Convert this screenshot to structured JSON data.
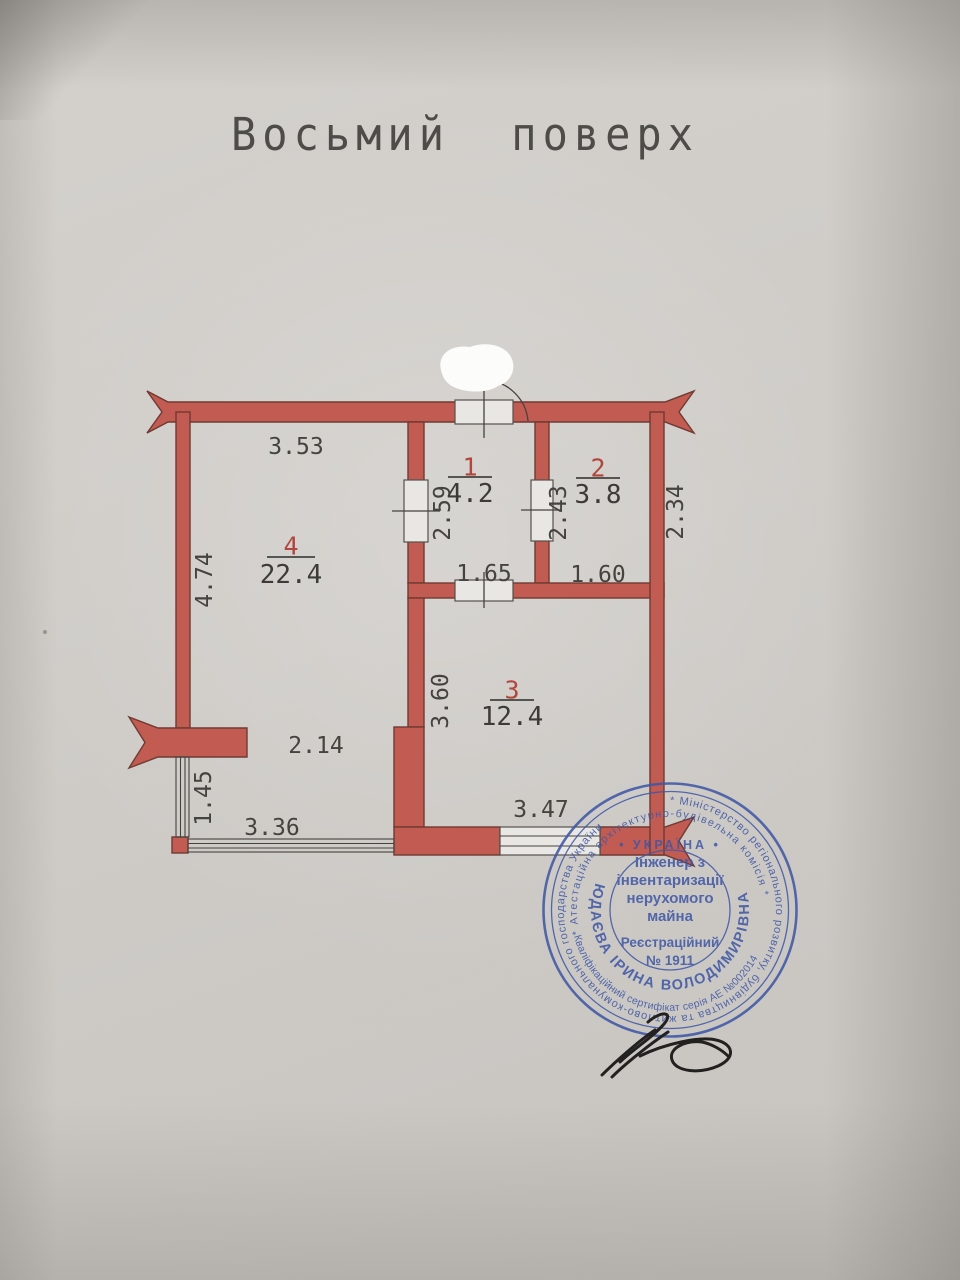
{
  "page": {
    "title": "Восьмий поверх"
  },
  "colors": {
    "wall_red": "#c25b51",
    "wall_outline": "#6f3a32",
    "line_dark": "#45433f",
    "room_number_red": "#b2453c",
    "stamp_blue": "#3f57a6",
    "signature_ink": "#23211f",
    "paper": "#cfccc8"
  },
  "plan": {
    "rooms": [
      {
        "number": "1",
        "area": "4.2"
      },
      {
        "number": "2",
        "area": "3.8"
      },
      {
        "number": "3",
        "area": "12.4"
      },
      {
        "number": "4",
        "area": "22.4"
      }
    ],
    "dimensions": {
      "room4_top": "3.53",
      "room4_left": "4.74",
      "room4_lower": "2.14",
      "room1_height": "2.59",
      "room1_width": "1.65",
      "room2_height": "2.43",
      "room2_width": "1.60",
      "room2_right": "2.34",
      "room3_height": "3.60",
      "room3_width": "3.47",
      "balcony_left": "1.45",
      "balcony_bottom": "3.36"
    }
  },
  "stamp": {
    "outer_ring": "* Міністерство регіонального розвитку, будівництва та житлово-комунального господарства України",
    "commission_ring": "* Атестаційна архітектурно-будівельна комісія *",
    "certificate_arc": "Кваліфікаційний сертифікат серія АЕ №002014",
    "name_arc": "ЮДАЄВА ІРИНА ВОЛОДИМИРІВНА",
    "country_line": "• УКРАЇНА •",
    "title_lines": [
      "Інженер з",
      "інвентаризації",
      "нерухомого",
      "майна"
    ],
    "registration_label": "Реєстраційний",
    "registration_number": "№ 1911"
  }
}
